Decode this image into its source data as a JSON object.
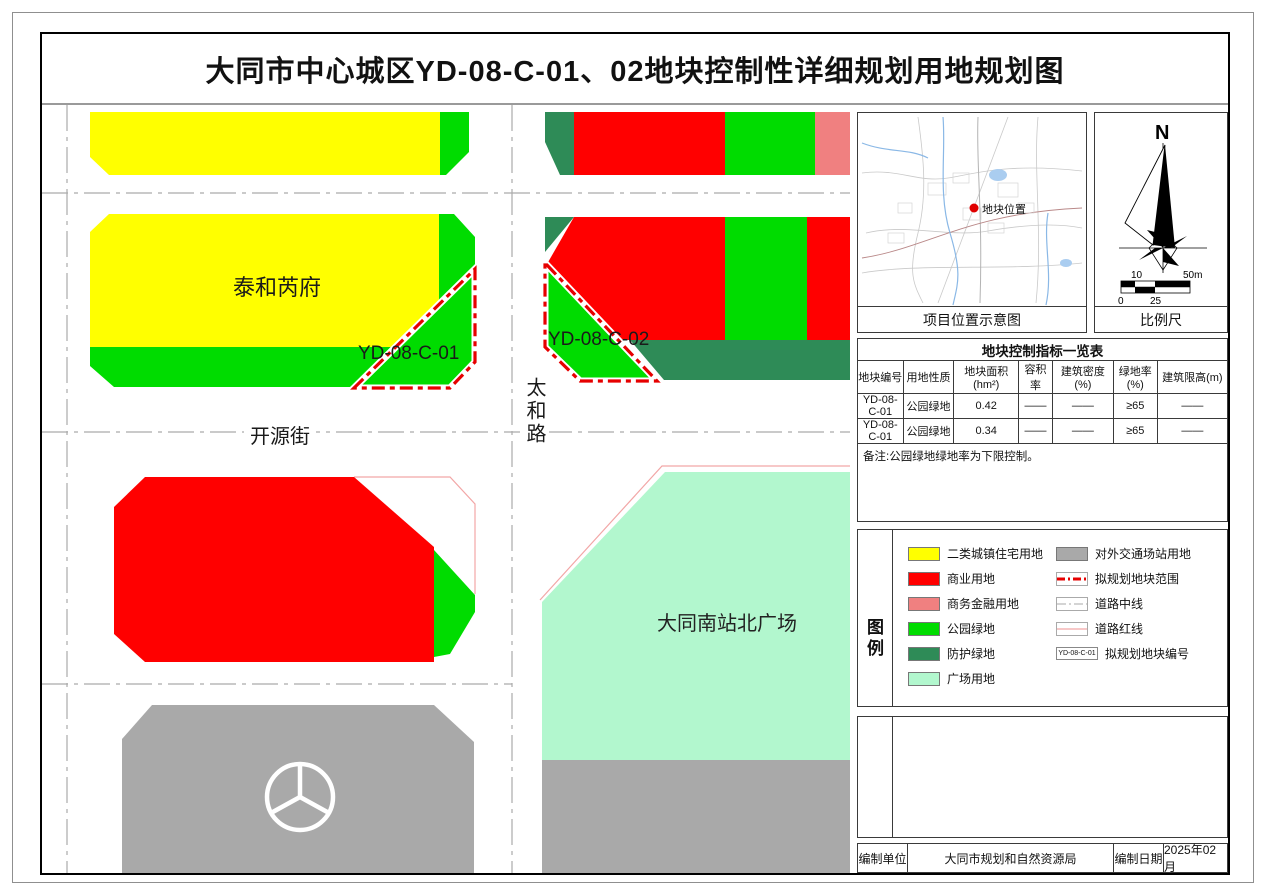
{
  "title": "大同市中心城区YD-08-C-01、02地块控制性详细规划用地规划图",
  "map": {
    "labels": {
      "residential_block": "泰和芮府",
      "plot1": "YD-08-C-01",
      "plot2": "YD-08-C-02",
      "street_horizontal": "开源街",
      "street_vertical": "太和路",
      "plaza": "大同南站北广场"
    }
  },
  "colors": {
    "residential": "#FFFF00",
    "commercial": "#FF0000",
    "business_finance": "#F08080",
    "park_green": "#00DC00",
    "protective_green": "#2E8B57",
    "plaza": "#B2F7CE",
    "transport_gray": "#A9A9A9",
    "plot_boundary": "#E60000",
    "road_centerline": "#AAAAAA",
    "road_redline": "#F2A6A6"
  },
  "location_map": {
    "marker_label": "地块位置",
    "caption": "项目位置示意图"
  },
  "compass": {
    "north_label": "N",
    "caption": "比例尺",
    "scale_ticks": [
      "0",
      "10",
      "25",
      "50m"
    ]
  },
  "table": {
    "title": "地块控制指标一览表",
    "headers": [
      "地块编号",
      "用地性质",
      "地块面积(hm²)",
      "容积率",
      "建筑密度(%)",
      "绿地率(%)",
      "建筑限高(m)"
    ],
    "rows": [
      [
        "YD-08-C-01",
        "公园绿地",
        "0.42",
        "——",
        "——",
        "≥65",
        "——"
      ],
      [
        "YD-08-C-01",
        "公园绿地",
        "0.34",
        "——",
        "——",
        "≥65",
        "——"
      ]
    ],
    "note": "备注:公园绿地绿地率为下限控制。"
  },
  "legend": {
    "title": "图例",
    "left_items": [
      {
        "label": "二类城镇住宅用地",
        "color": "#FFFF00"
      },
      {
        "label": "商业用地",
        "color": "#FF0000"
      },
      {
        "label": "商务金融用地",
        "color": "#F08080"
      },
      {
        "label": "公园绿地",
        "color": "#00DC00"
      },
      {
        "label": "防护绿地",
        "color": "#2E8B57"
      },
      {
        "label": "广场用地",
        "color": "#B2F7CE"
      }
    ],
    "right_items": [
      {
        "label": "对外交通场站用地",
        "color": "#A9A9A9"
      },
      {
        "label": "拟规划地块范围"
      },
      {
        "label": "道路中线"
      },
      {
        "label": "道路红线"
      },
      {
        "label": "拟规划地块编号",
        "box_text": "YD-08-C-01"
      }
    ]
  },
  "footer": {
    "org_label": "编制单位",
    "org_value": "大同市规划和自然资源局",
    "date_label": "编制日期",
    "date_value": "2025年02月"
  }
}
